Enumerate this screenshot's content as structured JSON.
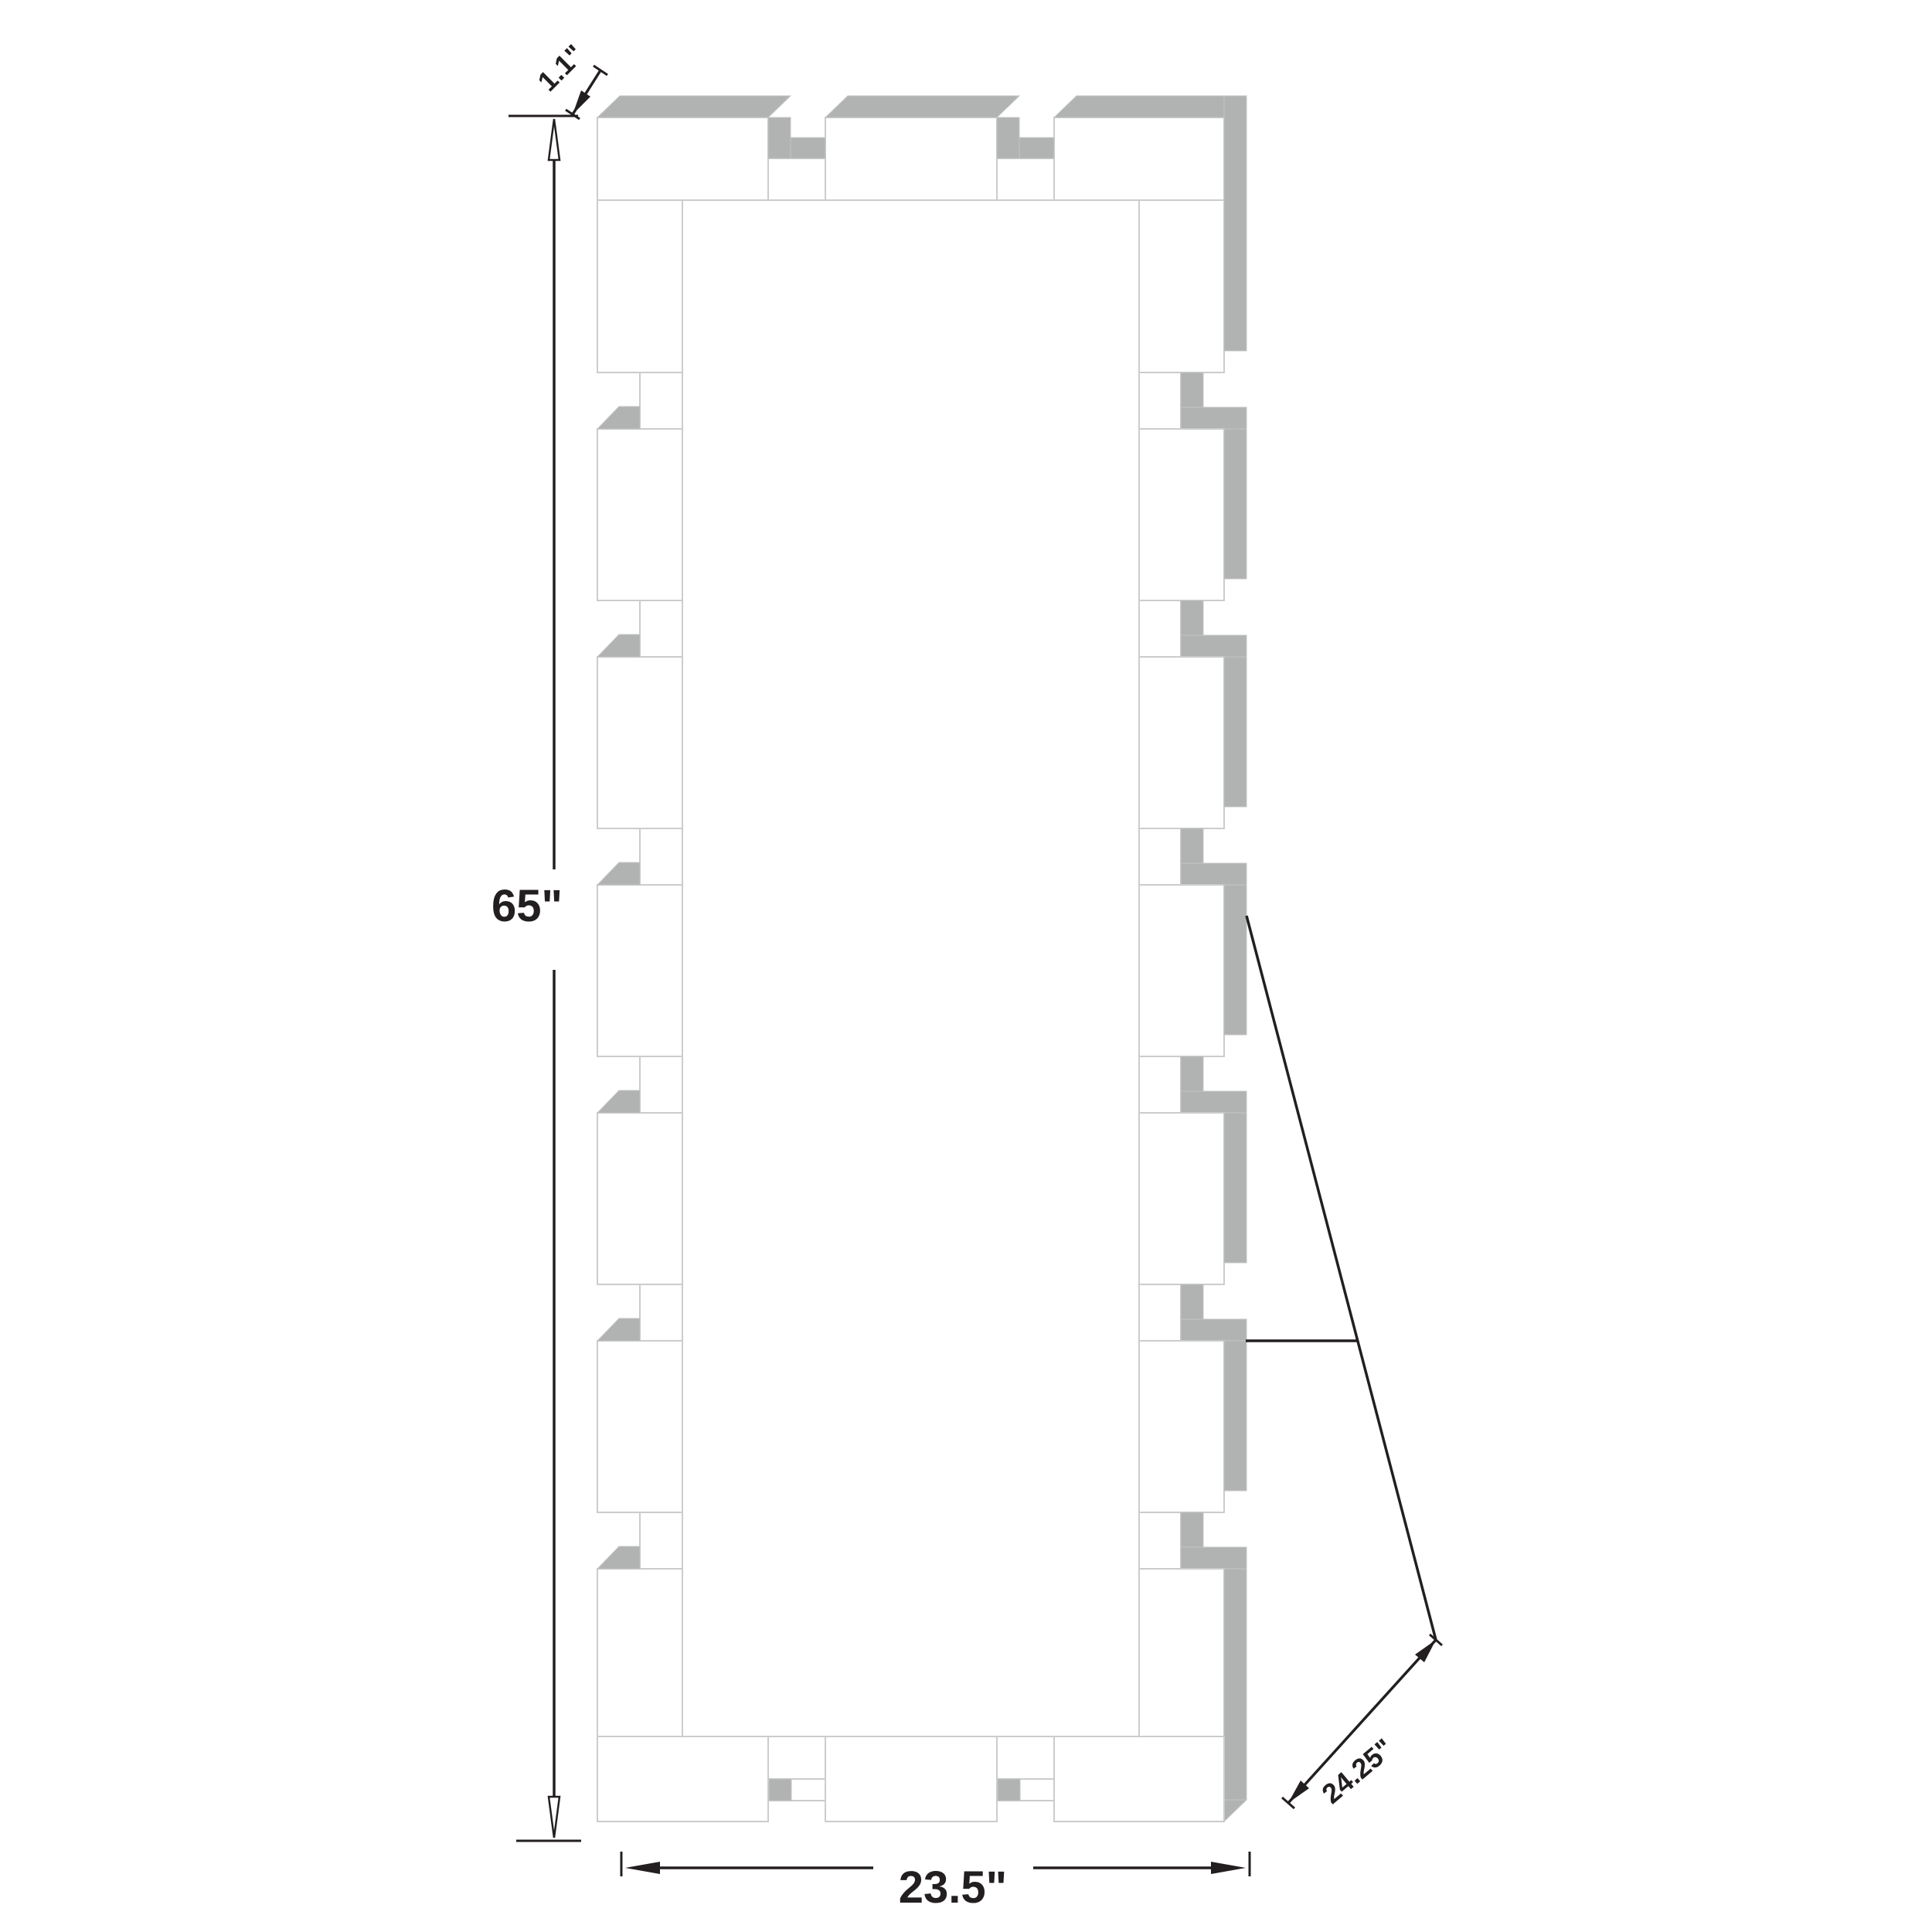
{
  "diagram": {
    "description": "frame-dimension-diagram",
    "dimensions": {
      "height": "65\"",
      "width": "23.5\"",
      "thickness": "1.1\"",
      "diagonal": "24.25\""
    },
    "colors": {
      "shadow_gray": "#b1b3b2",
      "outline_gray": "#cccccc",
      "dimension_ink": "#231f20",
      "background": "#ffffff"
    }
  }
}
